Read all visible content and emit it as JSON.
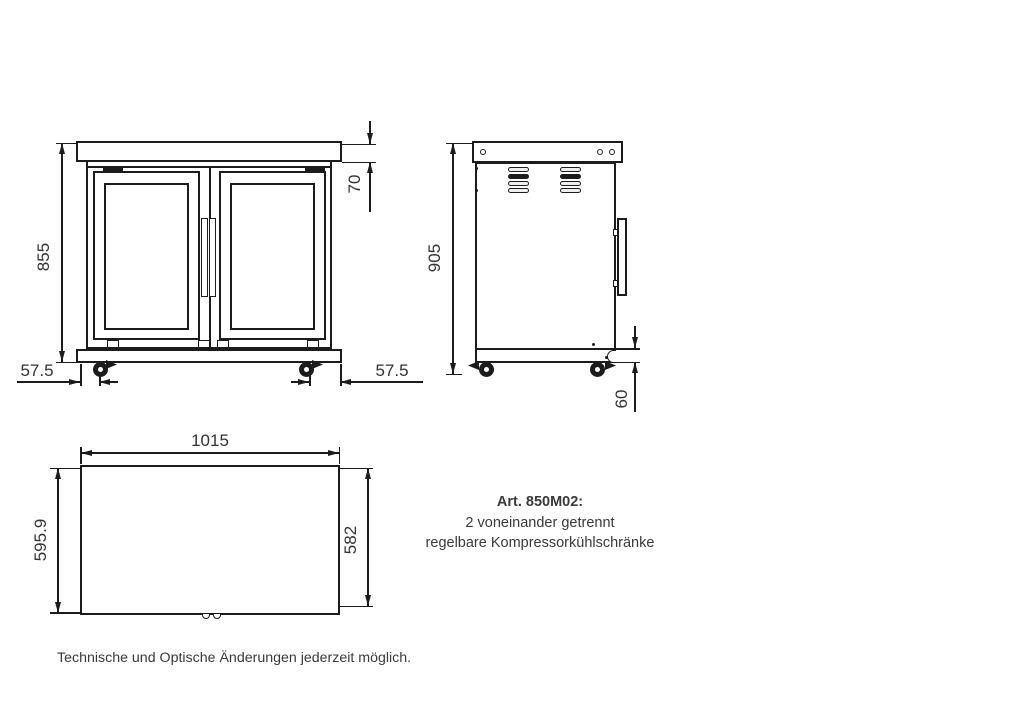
{
  "dims": {
    "front_height": "855",
    "front_top_offset": "70",
    "front_caster_offset_left": "57.5",
    "front_caster_offset_right": "57.5",
    "side_height": "905",
    "side_base_height": "60",
    "top_width": "1015",
    "top_depth_left": "595.9",
    "top_depth_right": "582"
  },
  "annotation": {
    "article_label": "Art. 850M02:",
    "line1": "2 voneinander getrennt",
    "line2": "regelbare Kompressorkühlschränke"
  },
  "footer_note": "Technische und Optische Änderungen jederzeit möglich."
}
